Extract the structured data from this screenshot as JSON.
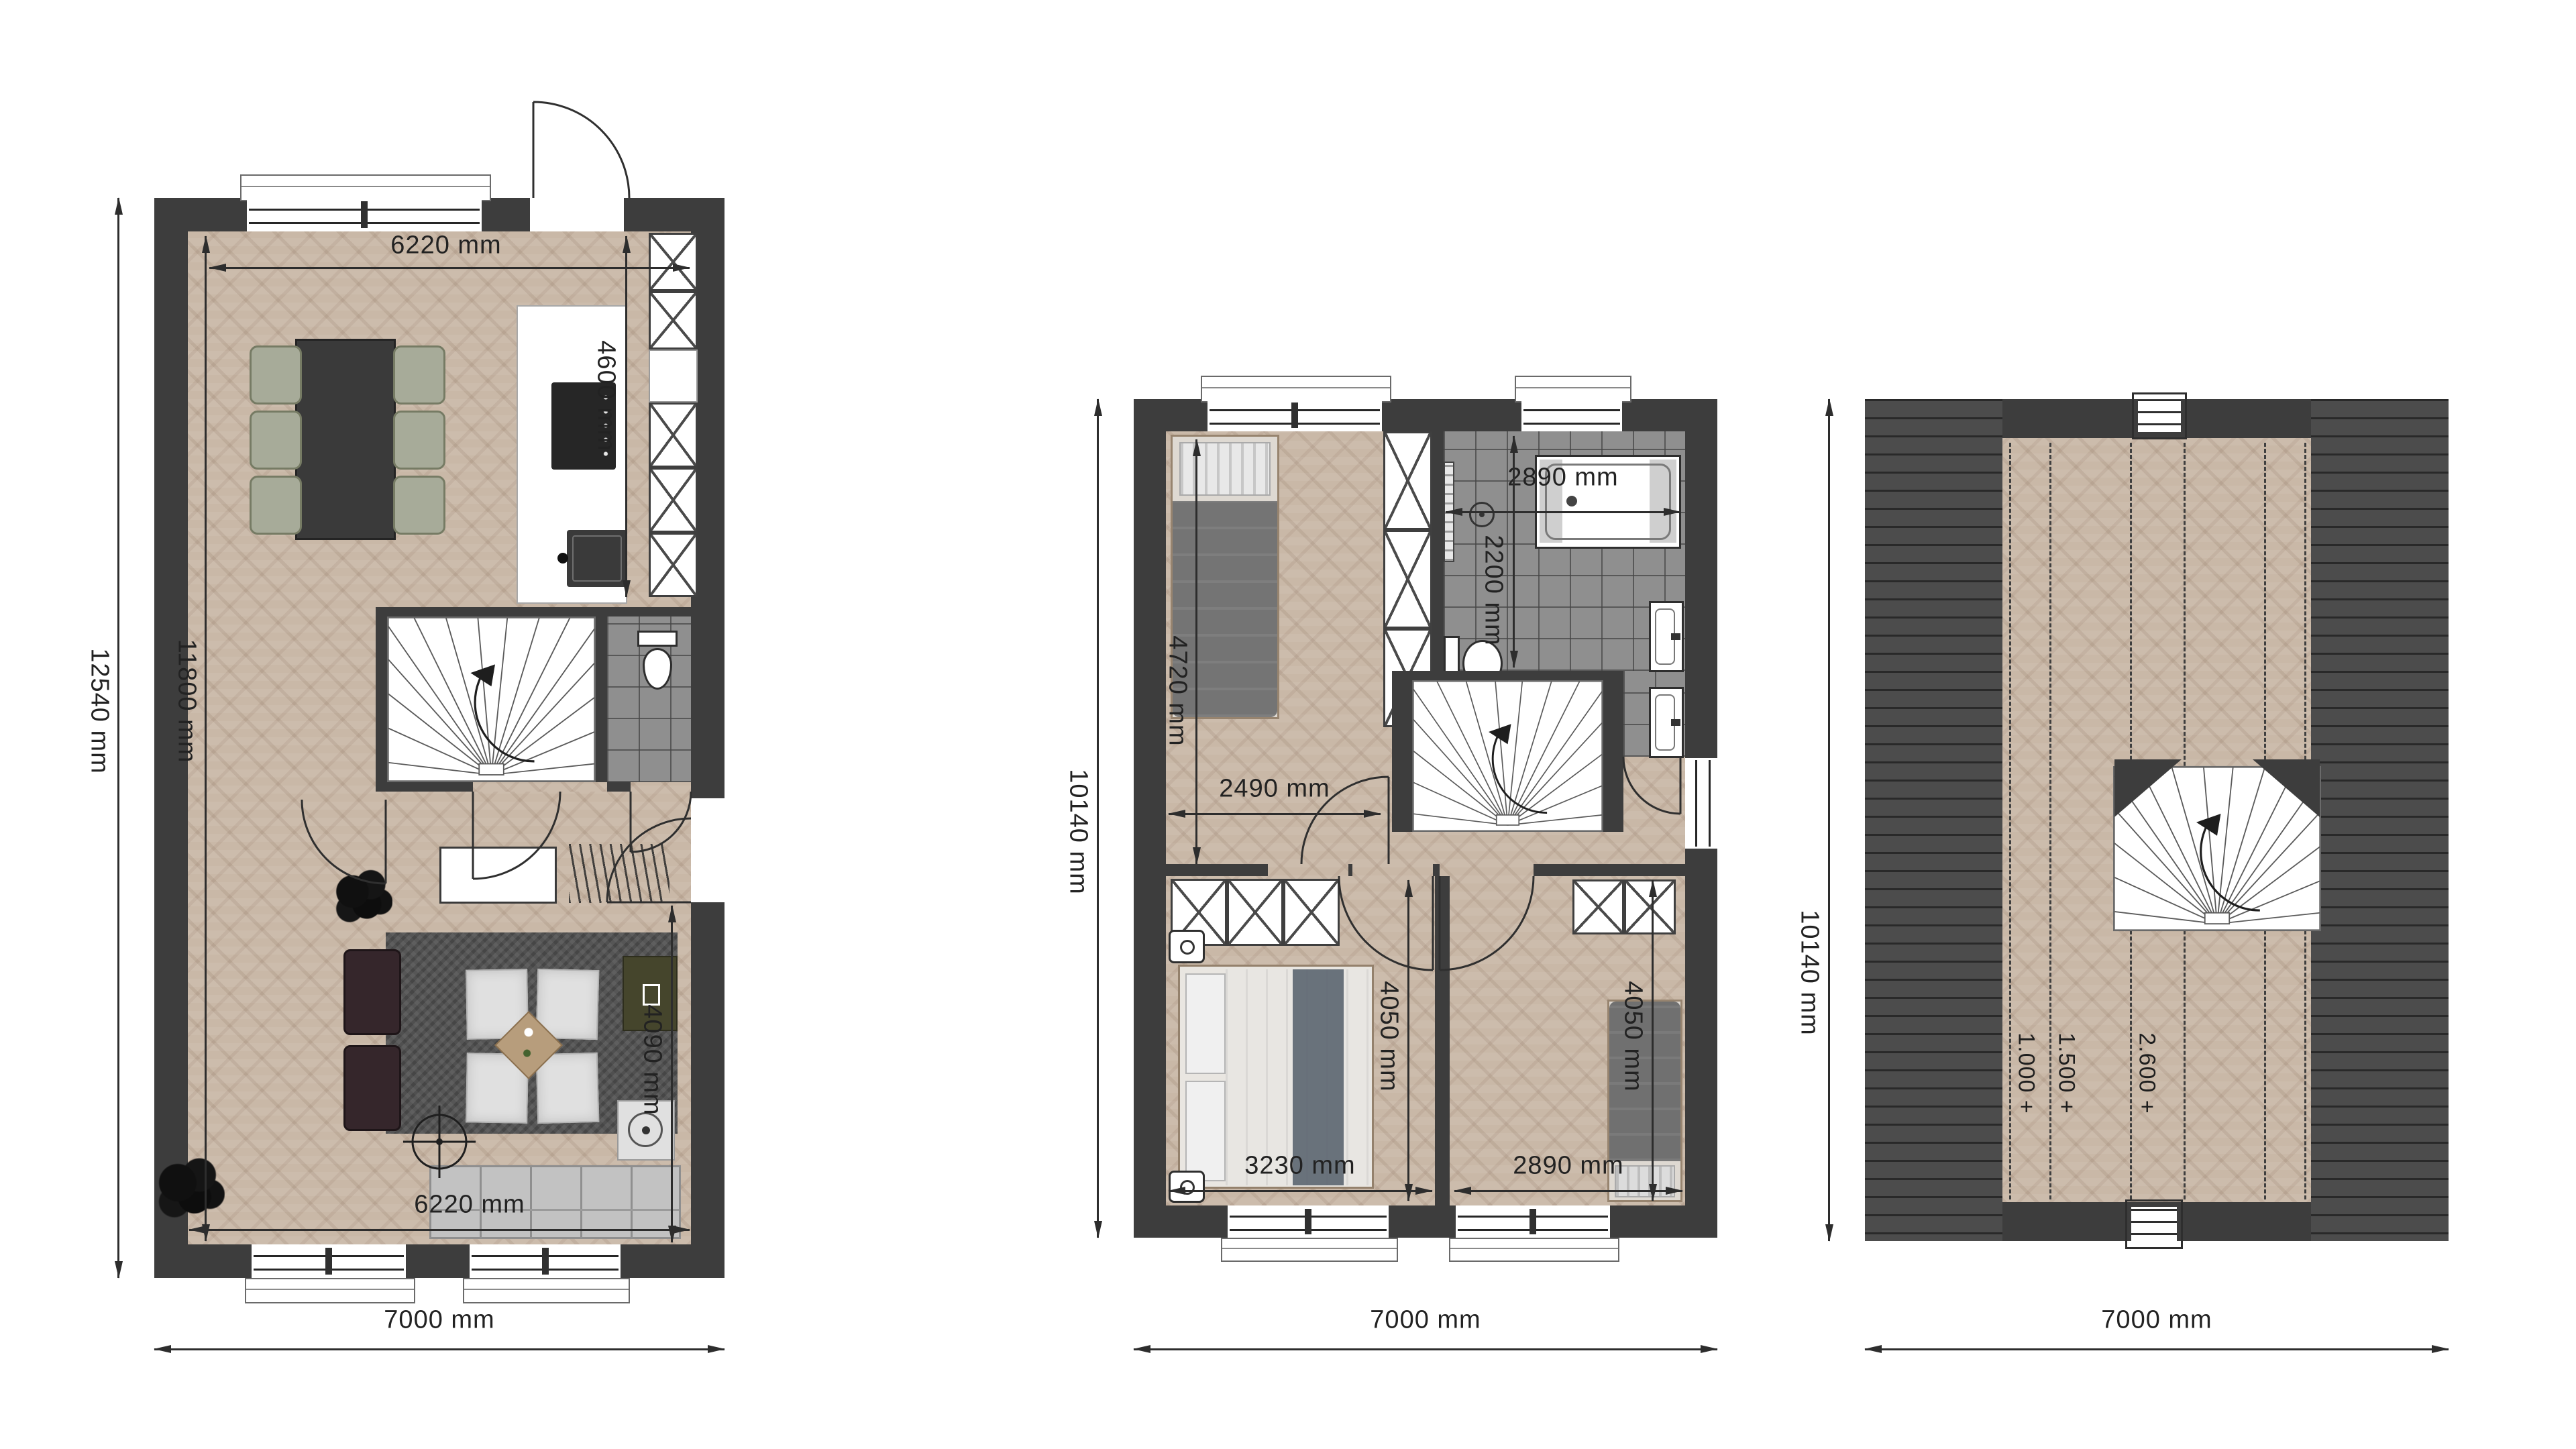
{
  "palette": {
    "wall": "#3d3d3d",
    "wood_floor": "#c9b8a7",
    "bathroom_tile": "#8f8f8f",
    "roof_planks": "#4c4c4c",
    "dimension_text": "#222222",
    "background": "#ffffff"
  },
  "ground_floor": {
    "dims": {
      "top_interior_width": "6220 mm",
      "kitchen_depth": "4600 mm",
      "interior_length": "11800 mm",
      "exterior_length": "12540 mm",
      "living_depth": "4090 mm",
      "bottom_interior_width": "6220 mm",
      "exterior_width": "7000 mm"
    }
  },
  "first_floor": {
    "dims": {
      "bathroom_width": "2890 mm",
      "bathroom_depth": "2200 mm",
      "bedroom1_depth": "4720 mm",
      "bedroom1_width": "2490 mm",
      "master_width": "3230 mm",
      "master_depth": "4050 mm",
      "bedroom2_width": "2890 mm",
      "bedroom2_depth": "4050 mm",
      "exterior_length": "10140 mm",
      "exterior_width": "7000 mm"
    }
  },
  "attic": {
    "dims": {
      "exterior_length": "10140 mm",
      "exterior_width": "7000 mm"
    },
    "contours": {
      "h1": "1.000 +",
      "h2": "1.500 +",
      "h3": "2.600 +"
    }
  }
}
